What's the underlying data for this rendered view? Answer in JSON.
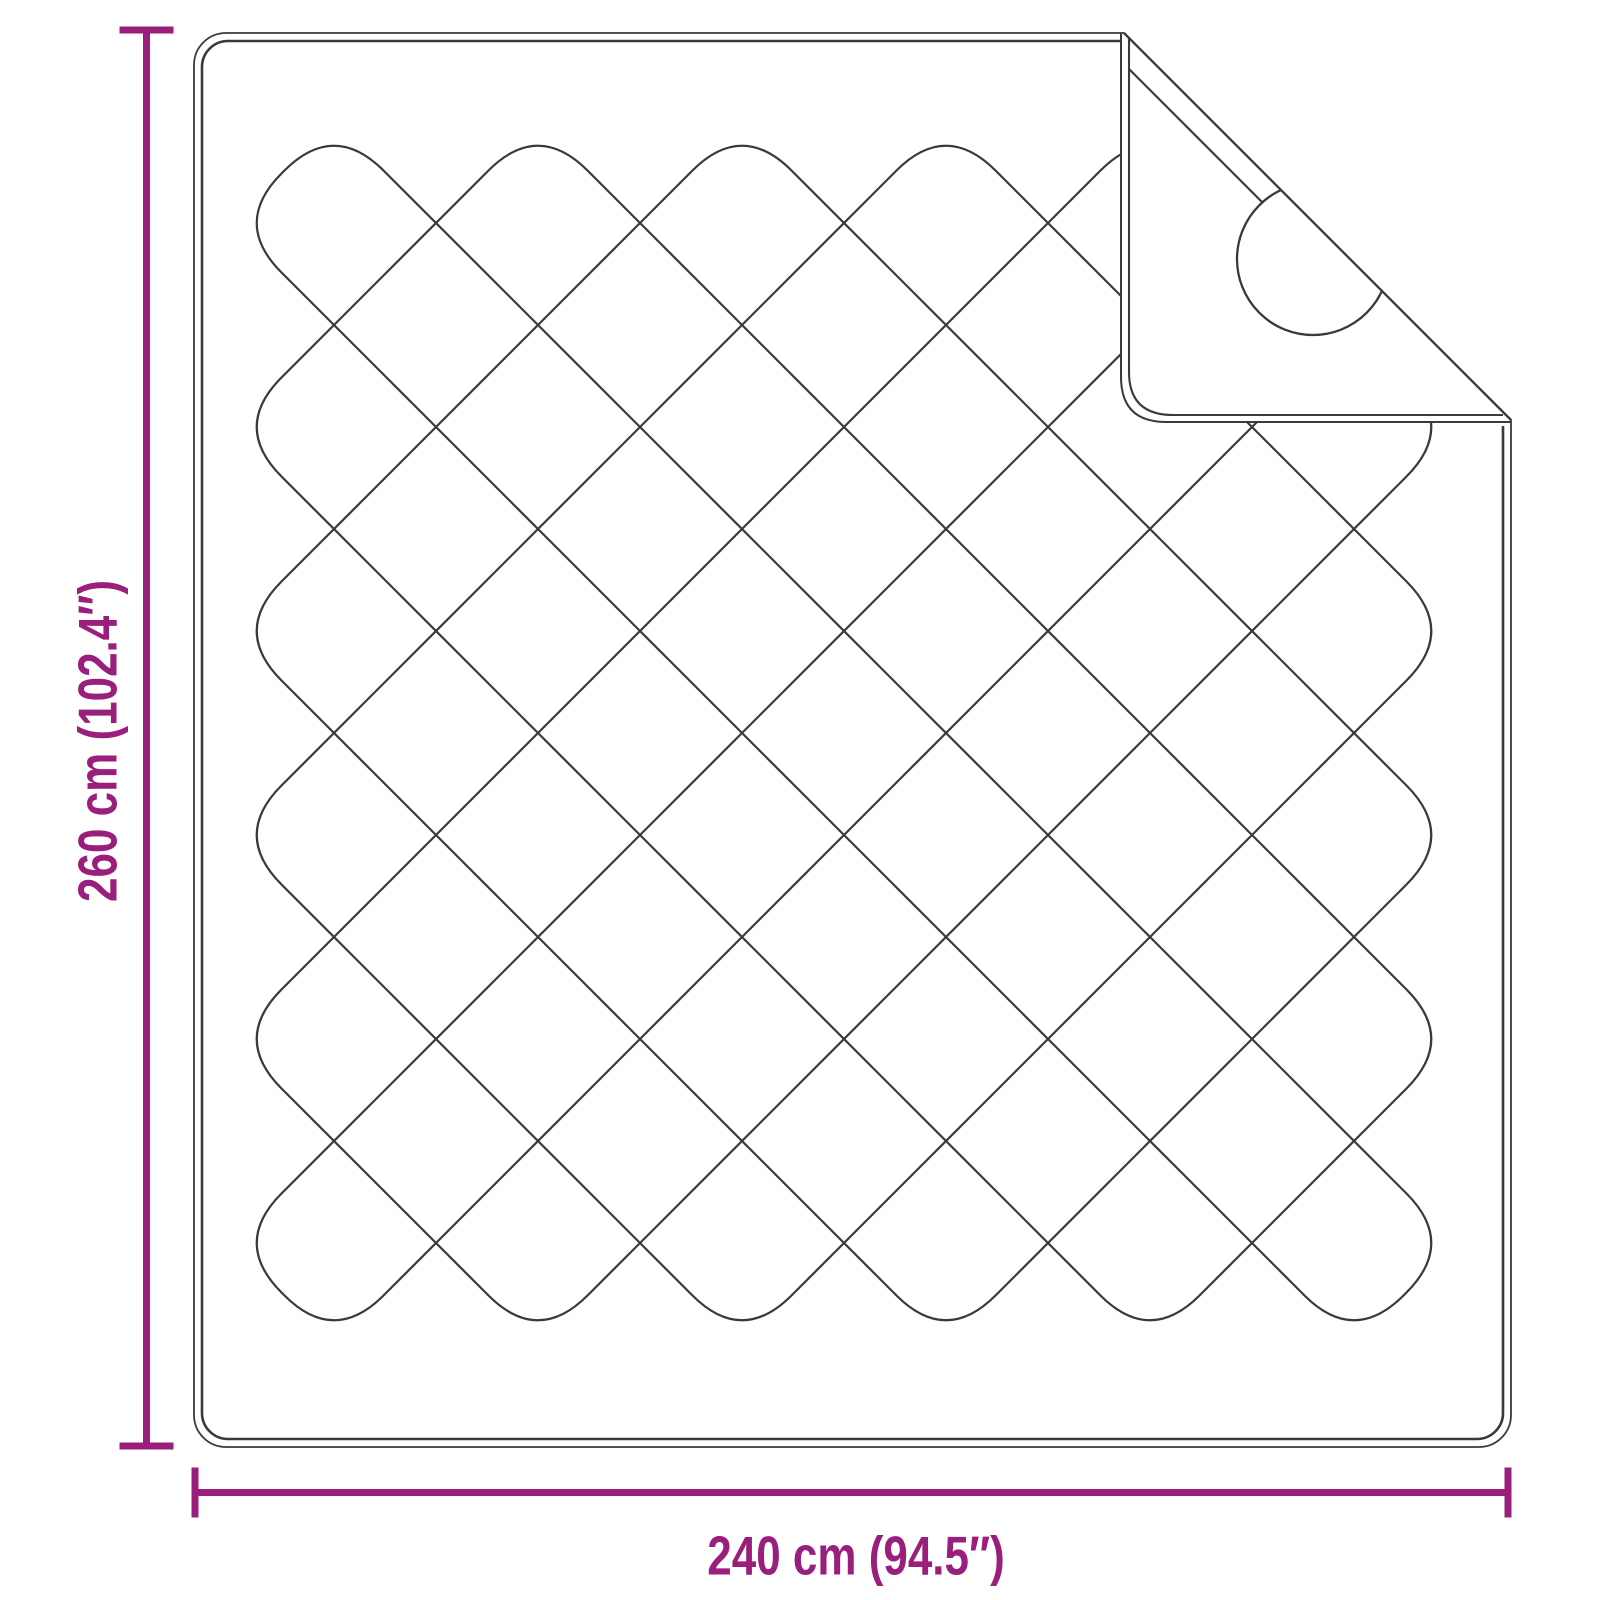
{
  "diagram": {
    "height_label": "260 cm (102.4″)",
    "width_label": "240 cm (94.5″)"
  },
  "colors": {
    "accent": "#9A1E7C",
    "line": "#3A3A3A",
    "background": "#FFFFFF"
  }
}
